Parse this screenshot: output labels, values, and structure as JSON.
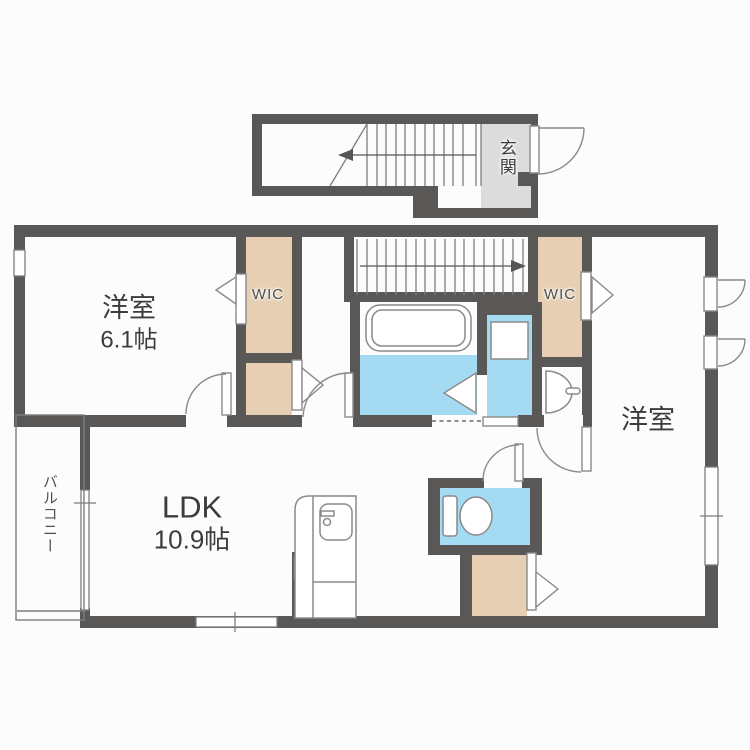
{
  "plan": {
    "type": "apartment-floor-plan",
    "labels": {
      "entrance": "玄関",
      "bedroom1": "洋室",
      "bedroom1_size": "6.1帖",
      "wic1": "WIC",
      "wic2": "WIC",
      "bedroom2": "洋室",
      "ldk": "LDK",
      "ldk_size": "10.9帖",
      "balcony": "バルコニー"
    },
    "colors": {
      "wall": "#5a5757",
      "closet_fill": "#e6cfb2",
      "wet_area_fill": "#a4daf2",
      "entrance_floor": "#dcdcdd",
      "line": "#7d7d7d",
      "text": "#3c3c3c",
      "background": "#fcfcfc"
    }
  }
}
